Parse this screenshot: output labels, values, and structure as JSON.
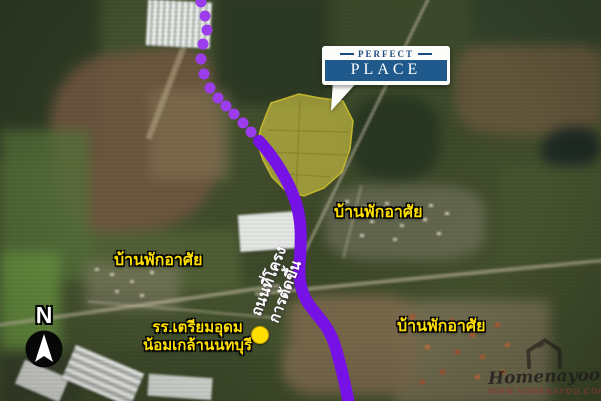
{
  "logo_card": {
    "line1": "PERFECT",
    "line2": "PLACE"
  },
  "labels": {
    "residential_top": "บ้านพักอาศัย",
    "residential_left": "บ้านพักอาศัย",
    "residential_right": "บ้านพักอาศัย",
    "school": {
      "line1": "รร.เตรียมอุดม",
      "line2": "น้อมเกล้านนทบุรี"
    },
    "project_road": {
      "line1": "ถนนที่โครง",
      "line2": "การตัดขึ้น"
    }
  },
  "compass": {
    "letter": "N"
  },
  "watermark": {
    "brand": "Homenayoo",
    "url": "WWW.HOMENAYOO.COM"
  },
  "colors": {
    "route": "#7712e6",
    "route_dot": "#9c3ded",
    "site_fill": "rgba(224,210,70,0.58)",
    "site_stroke": "rgba(205,190,45,0.9)",
    "label_yellow": "#ffdf00",
    "logo_bar_blue": "#205a8c",
    "logo_text_navy": "#1c4b7e"
  }
}
